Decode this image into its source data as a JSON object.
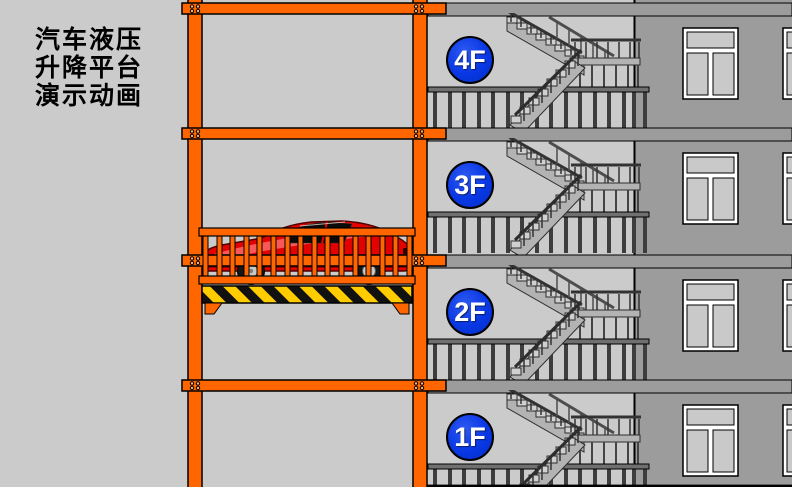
{
  "title": {
    "text": "汽车液压\n升降平台\n演示动画"
  },
  "floors": [
    {
      "label": "4F"
    },
    {
      "label": "3F"
    },
    {
      "label": "2F"
    },
    {
      "label": "1F"
    }
  ],
  "colors": {
    "frame_orange": "#FF6600",
    "hazard_yellow": "#FFCC00",
    "hazard_black": "#111111",
    "car_red": "#E20202",
    "floor_badge_blue": "#0837E4",
    "wall_gray": "#9C9C9C",
    "background_gray": "#CBCBCB",
    "stair_gray": "#B3B3B3"
  },
  "icons": {
    "floor_badge": "blue-circle-floor-label",
    "car": "red-sports-car-side-view",
    "stairs": "switchback-staircase",
    "platform": "hazard-striped-lift-platform",
    "lift_frame": "orange-steel-frame"
  }
}
